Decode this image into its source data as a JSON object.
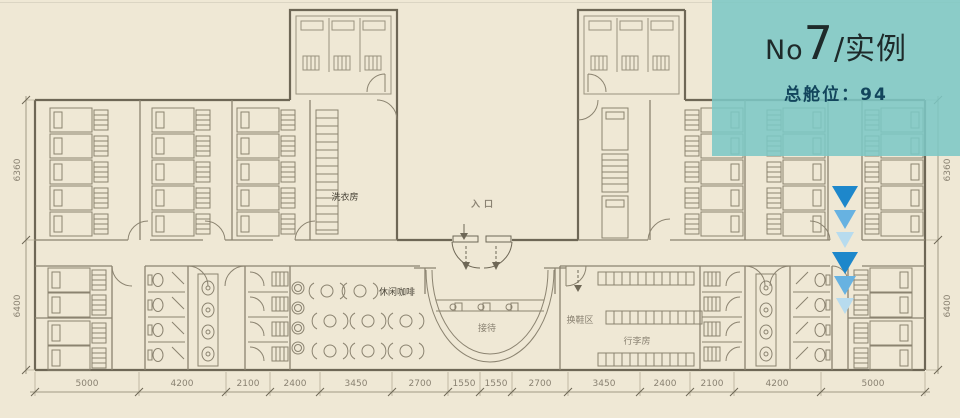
{
  "meta": {
    "background_color": "#efe8d5",
    "line_color": "#8b8370",
    "wall_color": "#6e6756",
    "dim_text_color": "#8a8272"
  },
  "banner": {
    "title_prefix": "No",
    "title_number": "7",
    "title_suffix": "/实例",
    "stat_label": "总舱位：",
    "stat_value": "94",
    "bg_color": "#7cc8c6",
    "title_color": "#1e2a2a",
    "stat_color": "#12455c"
  },
  "room_labels": {
    "laundry": "洗衣房",
    "entrance": "入口",
    "cafe": "休闲咖啡",
    "reception": "接待",
    "shoe_change": "换鞋区",
    "luggage": "行李房"
  },
  "dimensions": {
    "bottom": [
      "5000",
      "4200",
      "2100",
      "2400",
      "3450",
      "2700",
      "1550",
      "1550",
      "2700",
      "3450",
      "2400",
      "2100",
      "4200",
      "5000"
    ],
    "left_top": "6360",
    "left_bottom": "6400",
    "right_top": "6360",
    "right_bottom": "6400"
  },
  "flow_arrows": {
    "count": 6,
    "colors": [
      "#1d87cb",
      "#67b2e1",
      "#b7dbee"
    ]
  }
}
